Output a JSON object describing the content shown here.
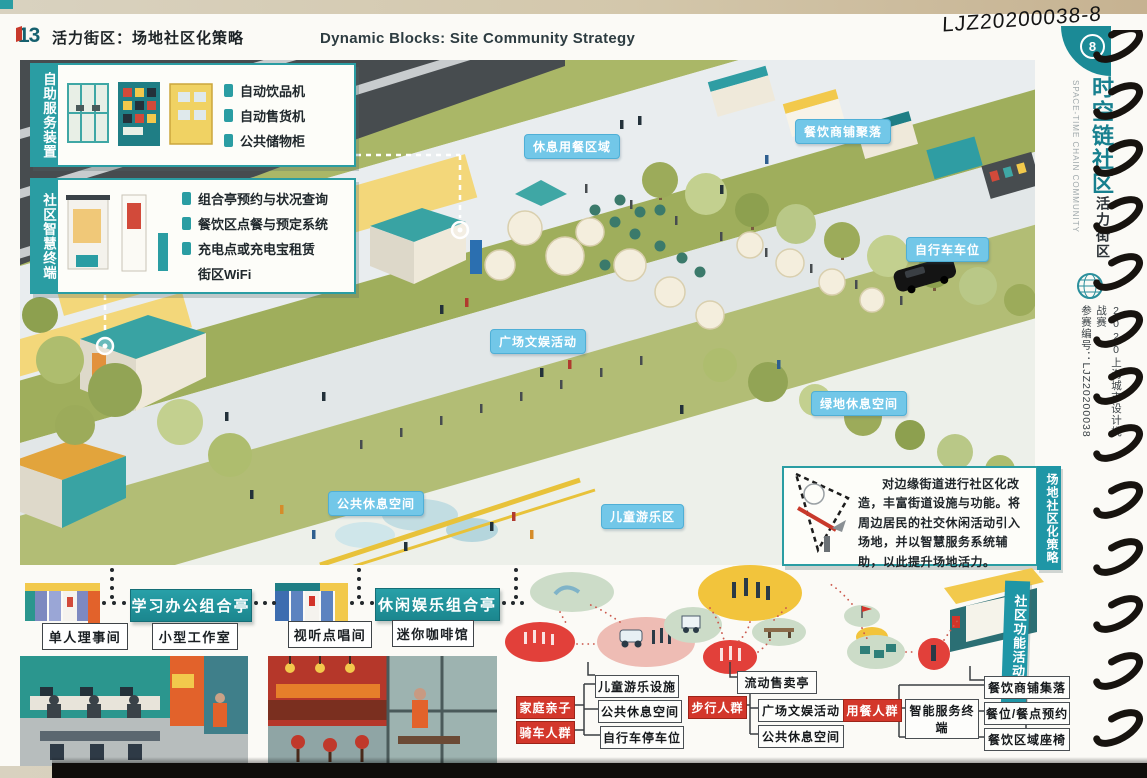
{
  "header": {
    "number": "13",
    "title_cn": "活力街区：场地社区化策略",
    "title_en": "Dynamic Blocks: Site Community Strategy",
    "handwritten_code": "LJZ20200038-8",
    "page_tab": "8"
  },
  "sidebar": {
    "series_cn": "时空链社区",
    "series_en": "SPACE-TIME CHAIN COMMUNITY",
    "chapter": "活力街区",
    "competition": "2020上海城市设计挑战赛",
    "entry": "参赛编号：LJZ20200038"
  },
  "callouts": [
    {
      "title": "自助服务装置",
      "items": [
        "自动饮品机",
        "自动售货机",
        "公共储物柜"
      ]
    },
    {
      "title": "社区智慧终端",
      "items": [
        "组合亭预约与状况查询",
        "餐饮区点餐与预定系统",
        "充电点或充电宝租赁",
        "街区WiFi"
      ]
    }
  ],
  "map_labels": [
    "休息用餐区域",
    "餐饮商铺聚落",
    "自行车车位",
    "广场文娱活动",
    "绿地休息空间",
    "公共休息空间",
    "儿童游乐区"
  ],
  "strategy": {
    "side_label": "场地社区化策略",
    "text": "对边缘街道进行社区化改造，丰富街道设施与功能。将周边居民的社交休闲活动引入场地，并以智慧服务系统辅助，以此提升场地活力。"
  },
  "pavilions": {
    "groups": [
      {
        "title": "学习办公组合亭",
        "rooms": [
          "单人理事间",
          "小型工作室"
        ]
      },
      {
        "title": "休闲娱乐组合亭",
        "rooms": [
          "视听点唱间",
          "迷你咖啡馆"
        ]
      }
    ]
  },
  "chain": {
    "side_label": "社区功能活动链",
    "flows": [
      {
        "actors": [
          "家庭亲子",
          "骑车人群"
        ],
        "targets": [
          "儿童游乐设施",
          "公共休息空间",
          "自行车停车位"
        ]
      },
      {
        "actors": [
          "步行人群"
        ],
        "targets": [
          "流动售卖亭",
          "广场文娱活动",
          "公共休息空间"
        ]
      },
      {
        "actors": [
          "用餐人群"
        ],
        "via": "智能服务终端",
        "targets": [
          "餐饮商铺集落",
          "餐位/餐点预约",
          "餐饮区域座椅"
        ]
      }
    ]
  },
  "colors": {
    "teal_accent": "#2a9da3",
    "label_blue": "#72c7e8",
    "actor_red": "#d3372b",
    "tab_teal": "#1b8a96"
  }
}
